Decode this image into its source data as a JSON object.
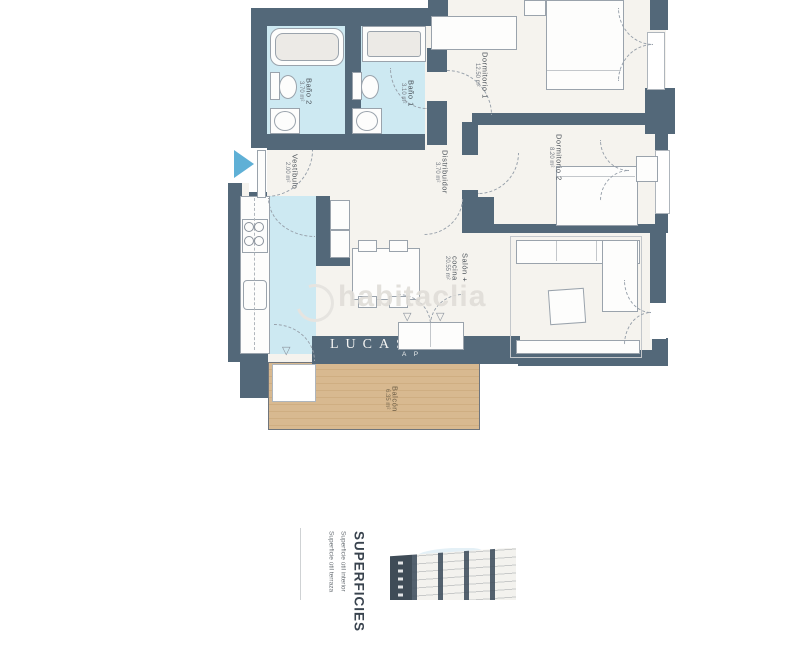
{
  "plan": {
    "rooms": [
      {
        "id": "bano2",
        "name": "Baño 2",
        "area": "3.70 m²"
      },
      {
        "id": "bano1",
        "name": "Baño 1",
        "area": "3.10 m²"
      },
      {
        "id": "vestibulo",
        "name": "Vestíbulo",
        "area": "2.00 m²"
      },
      {
        "id": "distribuidor",
        "name": "Distribuidor",
        "area": "3.70 m²"
      },
      {
        "id": "dormitorio1",
        "name": "Dormitorio 1",
        "area": "12.50 m²"
      },
      {
        "id": "dormitorio2",
        "name": "Dormitorio 2",
        "area": "8.20 m²"
      },
      {
        "id": "salon_cocina",
        "name": "Salón + cocina",
        "area": "20.55 m²"
      },
      {
        "id": "balcon",
        "name": "Balcón",
        "area": "6.35 m²"
      }
    ],
    "watermark_text": "habitaclia",
    "agency_watermark": {
      "line1": "LUCAS",
      "line2": "A P"
    },
    "door_marker": "▽",
    "icons": {
      "entrance_arrow": "solid right-pointing triangle",
      "habitaclia_logo": "light gray swirl circle"
    },
    "colors": {
      "wall": "#536879",
      "wet_room_floor": "#cde9f2",
      "room_floor": "#f5f3ee",
      "balcony_deck": "#d8b98f",
      "entrance_arrow": "#5fb0d6",
      "furniture_outline": "#9aa3ac",
      "watermark": "#e0ddd8"
    }
  },
  "legend": {
    "title": "SUPERFICIES",
    "lines": [
      "Superficie útil interior",
      "Superficie útil terraza"
    ]
  }
}
